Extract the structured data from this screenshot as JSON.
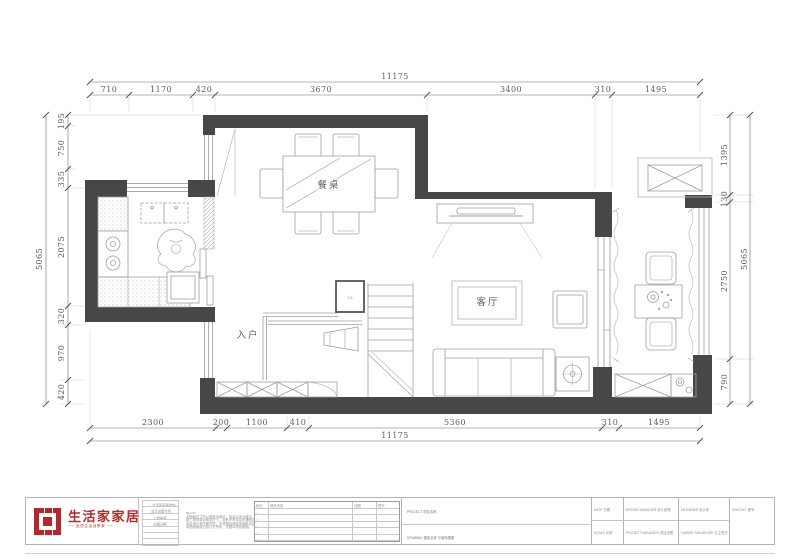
{
  "rooms": {
    "dining": "餐桌",
    "living": "客厅",
    "entry": "入户",
    "closet": "CL"
  },
  "dims": {
    "top": [
      "710",
      "1170",
      "420",
      "3670",
      "3400",
      "310",
      "1495"
    ],
    "top_total": "11175",
    "bottom": [
      "2300",
      "200",
      "1100",
      "410",
      "5360",
      "310",
      "1495"
    ],
    "bottom_total": "11175",
    "left": [
      "195",
      "750",
      "335",
      "2075",
      "320",
      "970",
      "420"
    ],
    "left_total": "5065",
    "right": [
      "1395",
      "130",
      "2750",
      "790"
    ],
    "right_total": "5065"
  },
  "titleblock": {
    "logo": {
      "name": "生活家家居",
      "tagline": "── 品质生活创享家 ──"
    },
    "company_rows": [
      "生活家家居装饰",
      "设计出图专用",
      "工程编号",
      "出图日期"
    ],
    "note": {
      "heading": "NOTE:",
      "lines": [
        "本图纸尺寸均以毫米为单位，标高以米为单位。",
        "施工前须核对现场尺寸，如有不符请及时通知设计师。",
        "未经设计师书面同意，不得擅自修改本图纸内容。",
        "本图纸版权归设计方所有，仅限本项目使用。"
      ]
    },
    "revisions": {
      "headers": [
        "标记",
        "修改内容",
        "日期",
        "签字"
      ],
      "symbol": "△"
    },
    "project": {
      "line1": "PROJECT  项目名称",
      "line2": "DRAWING  图纸名称  平面布置图"
    },
    "fields": {
      "date": "DATE  日期",
      "design_manager": "DESIGN MANAGER  设计经理",
      "designer": "DESIGNER  设计师",
      "scale": "SCALE  比例",
      "project_manager": "PROJECT MANAGER  项目经理",
      "owner_signature": "OWNER SIGNATURE  业主签字",
      "dwg_no": "DWG NO.  图号"
    }
  }
}
